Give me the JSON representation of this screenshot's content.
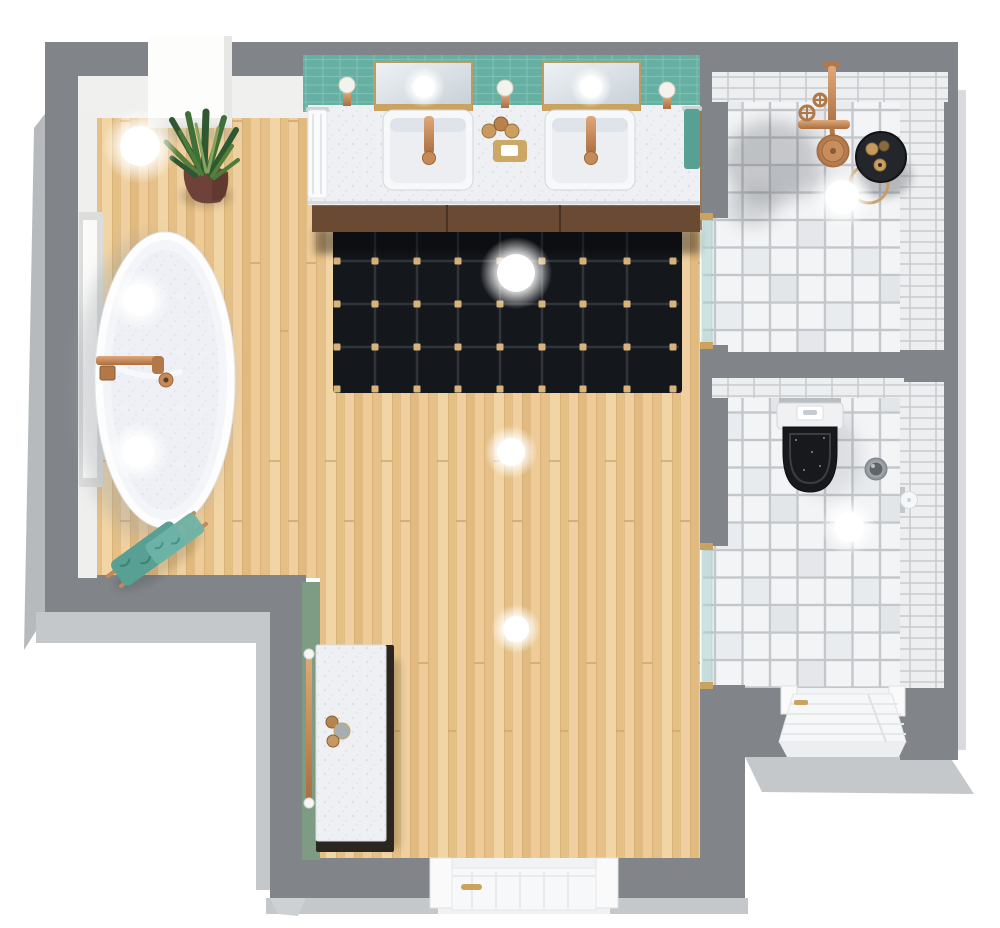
{
  "scene": {
    "title": "3D bathroom floor plan - top view",
    "rooms": [
      {
        "id": "main-bathroom",
        "floor_material": "light wood planks",
        "features": [
          "freestanding oval bathtub",
          "double-sink vanity with two mirrors and three sconces",
          "black grid-pattern rug",
          "potted snake plant",
          "leaning towel ladder with teal towels",
          "white side cabinet on sage accent wall",
          "window in left wall",
          "white exterior door at bottom",
          "white wall niche at top left"
        ]
      },
      {
        "id": "shower-room",
        "floor_material": "white square tiles",
        "features": [
          "copper ceiling rain shower with cross handles",
          "black round stool with gold toiletry bottles",
          "glass swing door"
        ]
      },
      {
        "id": "wc-room",
        "floor_material": "white square tiles",
        "features": [
          "wall-hung toilet with black seat and white flush plate",
          "round chrome waste bin",
          "toilet-paper holder",
          "glass swing door",
          "white exterior door at bottom"
        ]
      }
    ],
    "colors": {
      "background": "#ffffff",
      "wall": "#818488",
      "wall_outer": "#c5c8cb",
      "wall_inner": "#f0f0ee",
      "wood_base": "#ebc894",
      "tile": "#f3f4f6",
      "grout": "#c3c6ca",
      "teal_wall": "#66afa4",
      "sage_wall": "#7e9c83",
      "rug": "#14171c",
      "rug_line": "#3a4047",
      "rug_dot": "#d8b47b",
      "copper": "#c8895a",
      "gold": "#c9a35f",
      "towel_teal": "#58a094",
      "glass": "#aed6d0",
      "black_fixture": "#17191d",
      "white_fixture": "#f7f8fa"
    },
    "lights": [
      {
        "x": 140,
        "y": 146,
        "r": 20
      },
      {
        "x": 516,
        "y": 273,
        "r": 19
      },
      {
        "x": 511,
        "y": 452,
        "r": 14
      },
      {
        "x": 516,
        "y": 629,
        "r": 13
      },
      {
        "x": 842,
        "y": 197,
        "r": 17
      },
      {
        "x": 849,
        "y": 527,
        "r": 15
      },
      {
        "x": 139,
        "y": 300,
        "r": 16
      },
      {
        "x": 138,
        "y": 452,
        "r": 16
      },
      {
        "x": 424,
        "y": 87,
        "r": 11
      },
      {
        "x": 591,
        "y": 87,
        "r": 11
      }
    ],
    "rug": {
      "x": 333,
      "y": 226,
      "w": 349,
      "h": 167,
      "line_xs": [
        375,
        417,
        458,
        500,
        542,
        583,
        627
      ],
      "line_ys": [
        261,
        304,
        347
      ],
      "dot_xs": [
        337,
        375,
        417,
        458,
        500,
        542,
        583,
        627,
        673
      ],
      "dot_ys": [
        261,
        304,
        347,
        389
      ]
    }
  }
}
